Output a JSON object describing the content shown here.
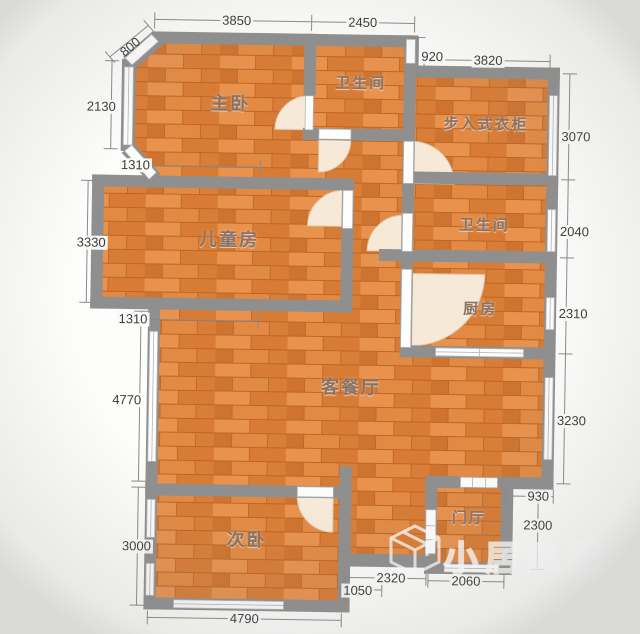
{
  "rooms": {
    "master_bedroom": "主卧",
    "bathroom_top": "卫生间",
    "walk_in_closet": "步入式衣柜",
    "kids_room": "儿童房",
    "bathroom_mid": "卫生间",
    "kitchen": "厨房",
    "living_dining": "客餐厅",
    "second_bedroom": "次卧",
    "foyer": "门厅"
  },
  "dimensions": {
    "top": [
      "3850",
      "2450"
    ],
    "upper_right": [
      "920",
      "3820"
    ],
    "left": [
      "800",
      "2130",
      "1310",
      "3330",
      "1310",
      "4770",
      "3000"
    ],
    "right": [
      "3070",
      "2040",
      "2310",
      "3230",
      "930",
      "2300"
    ],
    "bottom": [
      "2320",
      "1050",
      "4790",
      "2060"
    ]
  },
  "watermark": {
    "brand": "小居建配"
  },
  "colors": {
    "floor": "#df8340",
    "wall": "#8f8f8f",
    "dimension_text": "#3c3a38",
    "room_label": "#8a7264",
    "door_arc": "#f6e9d7"
  }
}
